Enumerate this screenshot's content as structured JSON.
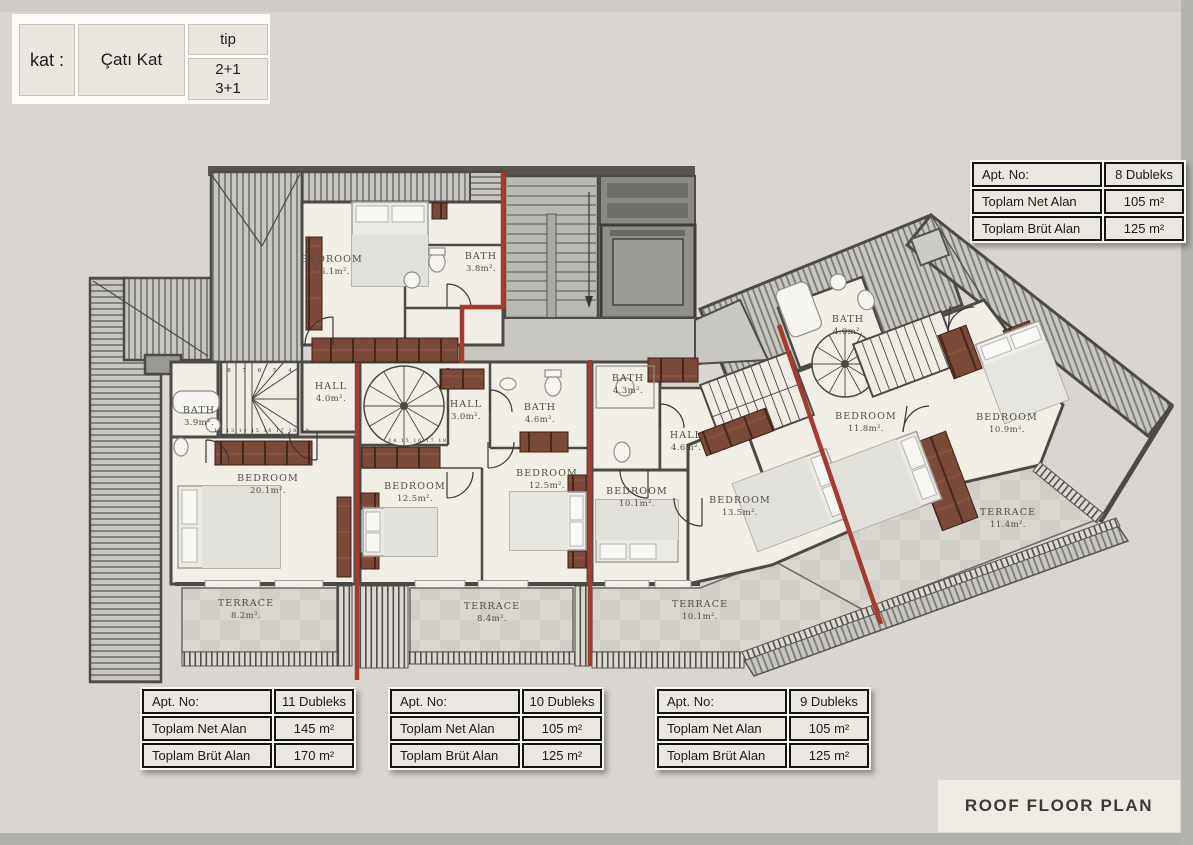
{
  "legend": {
    "kat_label": "kat :",
    "kat_value": "Çatı Kat",
    "tip_label": "tip",
    "tip_option1": "2+1",
    "tip_option2": "3+1"
  },
  "title": "ROOF FLOOR PLAN",
  "tables": {
    "apt8": {
      "rows": [
        {
          "label": "Apt. No:",
          "value": "8 Dubleks"
        },
        {
          "label": "Toplam Net Alan",
          "value": "105 m²"
        },
        {
          "label": "Toplam Brüt Alan",
          "value": "125 m²"
        }
      ]
    },
    "apt11": {
      "rows": [
        {
          "label": "Apt. No:",
          "value": "11 Dubleks"
        },
        {
          "label": "Toplam Net Alan",
          "value": "145 m²"
        },
        {
          "label": "Toplam Brüt Alan",
          "value": "170 m²"
        }
      ]
    },
    "apt10": {
      "rows": [
        {
          "label": "Apt. No:",
          "value": "10 Dubleks"
        },
        {
          "label": "Toplam Net Alan",
          "value": "105 m²"
        },
        {
          "label": "Toplam Brüt Alan",
          "value": "125 m²"
        }
      ]
    },
    "apt9": {
      "rows": [
        {
          "label": "Apt. No:",
          "value": "9 Dubleks"
        },
        {
          "label": "Toplam Net Alan",
          "value": "105 m²"
        },
        {
          "label": "Toplam Brüt Alan",
          "value": "125 m²"
        }
      ]
    }
  },
  "rooms": {
    "bedroom_16_1": {
      "name": "BEDROOM",
      "area": "16.1m²."
    },
    "bath_3_8": {
      "name": "BATH",
      "area": "3.8m²."
    },
    "hall_4_0": {
      "name": "HALL",
      "area": "4.0m²."
    },
    "bath_3_9": {
      "name": "BATH",
      "area": "3.9m²."
    },
    "bedroom_20_1": {
      "name": "BEDROOM",
      "area": "20.1m²."
    },
    "hall_3_0": {
      "name": "HALL",
      "area": "3.0m²."
    },
    "bath_4_6": {
      "name": "BATH",
      "area": "4.6m²."
    },
    "bedroom_12_5_a": {
      "name": "BEDROOM",
      "area": "12.5m²."
    },
    "bedroom_12_5_b": {
      "name": "BEDROOM",
      "area": "12.5m²."
    },
    "bath_4_3": {
      "name": "BATH",
      "area": "4.3m²."
    },
    "hall_4_6": {
      "name": "HALL",
      "area": "4.6m²."
    },
    "bedroom_10_1": {
      "name": "BEDROOM",
      "area": "10.1m²."
    },
    "bedroom_13_5": {
      "name": "BEDROOM",
      "area": "13.5m²."
    },
    "bath_4_0": {
      "name": "BATH",
      "area": "4.0m²."
    },
    "bedroom_11_8": {
      "name": "BEDROOM",
      "area": "11.8m²."
    },
    "bedroom_10_9": {
      "name": "BEDROOM",
      "area": "10.9m²."
    },
    "terrace_8_2": {
      "name": "TERRACE",
      "area": "8.2m²."
    },
    "terrace_8_4": {
      "name": "TERRACE",
      "area": "8.4m²."
    },
    "terrace_10_1": {
      "name": "TERRACE",
      "area": "10.1m²."
    },
    "terrace_11_4": {
      "name": "TERRACE",
      "area": "11.4m²."
    }
  },
  "stairs": {
    "upper_run": "8 7 6 5 4",
    "lower_run": "12 13 14 15 16 17 18 19",
    "spiral_run": "14 15 16 17 18"
  },
  "colors": {
    "accent_red": "#a8392f",
    "wall": "#4c4a47",
    "room_floor": "#f1eee6",
    "roof_base": "#c8c6c0"
  }
}
